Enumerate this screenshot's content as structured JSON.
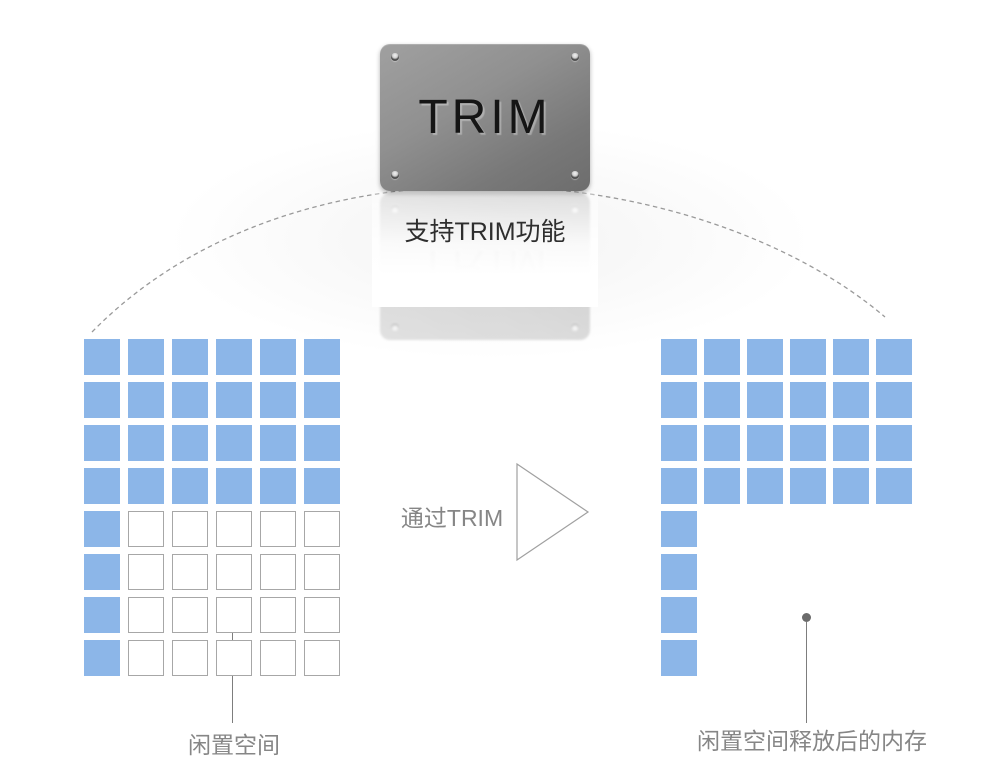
{
  "badge": {
    "title": "TRIM"
  },
  "caption": {
    "text": "支持TRIM功能"
  },
  "transition": {
    "label": "通过TRIM"
  },
  "grids": {
    "before": {
      "cols": 6,
      "rows": [
        "UUUUUU",
        "UUUUUU",
        "UUUUUU",
        "UUUUUU",
        "UFFFFF",
        "UFFFFF",
        "UFFFFF",
        "UFFFFF"
      ]
    },
    "after": {
      "cols": 6,
      "rows": [
        "UUUUUU",
        "UUUUUU",
        "UUUUUU",
        "UUUUUU",
        "UEEEEE",
        "UEEEEE",
        "UEEEEE",
        "UEEEEE"
      ]
    }
  },
  "cell_legend": {
    "U": "used block (blue)",
    "F": "free block (white outline)",
    "E": "released empty slot"
  },
  "callouts": {
    "before": {
      "label": "闲置空间"
    },
    "after": {
      "label": "闲置空间释放后的内存"
    }
  },
  "colors": {
    "block": "#8cb6e8",
    "free_border": "#a7a7a7",
    "arc": "#9a9a9a",
    "label": "#868686",
    "caption": "#2e2e2e"
  }
}
